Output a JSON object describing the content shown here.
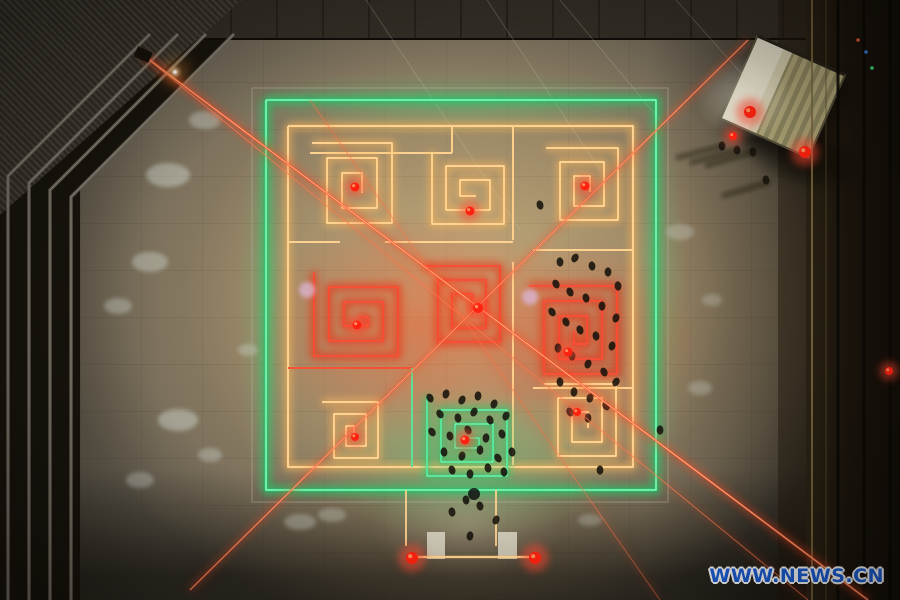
{
  "watermark": {
    "text": "WWW.NEWS.CN",
    "color": "#1a5ed8"
  },
  "palette": {
    "warm_core": "#ffeec4",
    "warm_glow": "#ffb85c",
    "green_core": "#a4ffd2",
    "green_glow": "#17cf6a",
    "red_core": "#ff7a55",
    "red_glow": "#ef2410",
    "beam": "#ff4a22",
    "beam_core": "#ffc79c",
    "metal": "#6e695e",
    "metal_hi": "#b4af9f",
    "person": "#17120b",
    "snow": "#ccd1c8",
    "shadow": "#100c06",
    "ramp": "#d8d3c2",
    "lantern": "#ff2210",
    "lantern_glow": "#ff4a30",
    "lantern_hi": "#ff8c5a"
  },
  "rails": [
    [
      [
        150,
        34
      ],
      [
        8,
        176
      ],
      [
        8,
        600
      ]
    ],
    [
      [
        178,
        34
      ],
      [
        29,
        183
      ],
      [
        29,
        600
      ]
    ],
    [
      [
        206,
        34
      ],
      [
        50,
        190
      ],
      [
        50,
        600
      ]
    ],
    [
      [
        234,
        34
      ],
      [
        71,
        197
      ],
      [
        71,
        600
      ]
    ]
  ],
  "strip_lines": [
    {
      "x": 812,
      "c": "#7a6a40",
      "w": 2,
      "o": 0.85
    },
    {
      "x": 838,
      "c": "#0b0905",
      "w": 3,
      "o": 0.9
    },
    {
      "x": 864,
      "c": "#0b0905",
      "w": 3,
      "o": 0.9
    },
    {
      "x": 890,
      "c": "#0b0905",
      "w": 3,
      "o": 0.9
    },
    {
      "x": 826,
      "c": "#5c4d2c",
      "w": 1.2,
      "o": 0.6
    }
  ],
  "snow_patches": [
    [
      168,
      175,
      22,
      12,
      0.5
    ],
    [
      150,
      262,
      18,
      10,
      0.45
    ],
    [
      118,
      306,
      14,
      8,
      0.4
    ],
    [
      178,
      420,
      20,
      11,
      0.5
    ],
    [
      210,
      455,
      12,
      7,
      0.4
    ],
    [
      300,
      522,
      16,
      8,
      0.38
    ],
    [
      680,
      232,
      14,
      8,
      0.35
    ],
    [
      700,
      388,
      12,
      7,
      0.32
    ],
    [
      248,
      350,
      10,
      6,
      0.4
    ],
    [
      332,
      515,
      14,
      7,
      0.35
    ],
    [
      590,
      520,
      12,
      6,
      0.3
    ],
    [
      712,
      300,
      10,
      6,
      0.3
    ],
    [
      205,
      120,
      16,
      9,
      0.45
    ],
    [
      140,
      480,
      14,
      8,
      0.42
    ]
  ],
  "cables": [
    [
      366,
      0,
      520,
      230
    ],
    [
      487,
      0,
      600,
      170
    ],
    [
      676,
      0,
      758,
      92
    ],
    [
      560,
      0,
      660,
      120
    ]
  ],
  "fence": [
    [
      252,
      88
    ],
    [
      668,
      88
    ],
    [
      668,
      502
    ],
    [
      252,
      502
    ],
    [
      252,
      88
    ]
  ],
  "maze": {
    "borders": [
      {
        "pts": [
          [
            266,
            100
          ],
          [
            656,
            100
          ],
          [
            656,
            490
          ],
          [
            266,
            490
          ],
          [
            266,
            100
          ]
        ],
        "type": "green",
        "w": 2.8
      },
      {
        "pts": [
          [
            288,
            126
          ],
          [
            633,
            126
          ],
          [
            633,
            467
          ],
          [
            288,
            467
          ],
          [
            288,
            126
          ]
        ],
        "type": "warm",
        "w": 2.2
      }
    ],
    "connectors": [
      {
        "pts": [
          [
            310,
            153
          ],
          [
            452,
            153
          ]
        ],
        "type": "warm"
      },
      {
        "pts": [
          [
            452,
            126
          ],
          [
            452,
            153
          ]
        ],
        "type": "warm"
      },
      {
        "pts": [
          [
            513,
            126
          ],
          [
            513,
            240
          ]
        ],
        "type": "warm"
      },
      {
        "pts": [
          [
            513,
            262
          ],
          [
            513,
            465
          ]
        ],
        "type": "warm"
      },
      {
        "pts": [
          [
            288,
            242
          ],
          [
            340,
            242
          ]
        ],
        "type": "warm"
      },
      {
        "pts": [
          [
            385,
            242
          ],
          [
            513,
            242
          ]
        ],
        "type": "warm"
      },
      {
        "pts": [
          [
            288,
            368
          ],
          [
            412,
            368
          ]
        ],
        "type": "red"
      },
      {
        "pts": [
          [
            533,
            250
          ],
          [
            633,
            250
          ]
        ],
        "type": "warm"
      },
      {
        "pts": [
          [
            533,
            388
          ],
          [
            633,
            388
          ]
        ],
        "type": "warm"
      },
      {
        "pts": [
          [
            412,
            368
          ],
          [
            412,
            467
          ]
        ],
        "type": "green"
      }
    ],
    "spirals": [
      {
        "cx": 352,
        "cy": 183,
        "r": 40,
        "gap": 15,
        "ccw": false,
        "type": "warm"
      },
      {
        "cx": 468,
        "cy": 188,
        "r": 36,
        "gap": 14,
        "ccw": true,
        "type": "warm"
      },
      {
        "cx": 582,
        "cy": 184,
        "r": 36,
        "gap": 14,
        "ccw": false,
        "type": "warm"
      },
      {
        "cx": 356,
        "cy": 314,
        "r": 42,
        "gap": 15,
        "ccw": true,
        "type": "red"
      },
      {
        "cx": 462,
        "cy": 304,
        "r": 38,
        "gap": 14,
        "ccw": false,
        "type": "red"
      },
      {
        "cx": 573,
        "cy": 330,
        "r": 44,
        "gap": 15,
        "ccw": false,
        "type": "red"
      },
      {
        "cx": 350,
        "cy": 430,
        "r": 28,
        "gap": 12,
        "ccw": false,
        "type": "warm"
      },
      {
        "cx": 467,
        "cy": 436,
        "r": 40,
        "gap": 14,
        "ccw": true,
        "type": "green"
      },
      {
        "cx": 580,
        "cy": 420,
        "r": 36,
        "gap": 14,
        "ccw": false,
        "type": "warm"
      }
    ]
  },
  "entrance": {
    "verticals": [
      [
        [
          406,
          490
        ],
        [
          406,
          546
        ]
      ],
      [
        [
          496,
          490
        ],
        [
          496,
          546
        ]
      ]
    ],
    "bar": [
      [
        410,
        557
      ],
      [
        534,
        557
      ]
    ],
    "ramps": [
      [
        427,
        532,
        18,
        27
      ],
      [
        498,
        532,
        19,
        27
      ]
    ],
    "post_blob": [
      474,
      494
    ]
  },
  "beams": [
    {
      "x1": 143,
      "y1": 55,
      "x2": 868,
      "y2": 600,
      "w": 2.2,
      "o": 0.85
    },
    {
      "x1": 143,
      "y1": 55,
      "x2": 808,
      "y2": 600,
      "w": 1.3,
      "o": 0.45
    },
    {
      "x1": 748,
      "y1": 40,
      "x2": 190,
      "y2": 590,
      "w": 1.8,
      "o": 0.7
    },
    {
      "x1": 310,
      "y1": 100,
      "x2": 660,
      "y2": 600,
      "w": 1.1,
      "o": 0.4
    }
  ],
  "flare": {
    "x": 175,
    "y": 72,
    "fixture": [
      143,
      55
    ]
  },
  "lanterns": [
    [
      355,
      187,
      4.5
    ],
    [
      470,
      211,
      4.5
    ],
    [
      585,
      186,
      4.5
    ],
    [
      357,
      325,
      4.5
    ],
    [
      478,
      308,
      5
    ],
    [
      568,
      352,
      4.5
    ],
    [
      355,
      437,
      4
    ],
    [
      465,
      440,
      4.5
    ],
    [
      577,
      412,
      4
    ],
    [
      412,
      558,
      6
    ],
    [
      535,
      558,
      6
    ],
    [
      750,
      112,
      6
    ],
    [
      805,
      152,
      6
    ],
    [
      733,
      136,
      4
    ],
    [
      889,
      371,
      4
    ]
  ],
  "tent_leds": [
    [
      866,
      52,
      "#4488ff"
    ],
    [
      872,
      68,
      "#44ff88"
    ],
    [
      858,
      40,
      "#ff6633"
    ]
  ],
  "balloons": [
    [
      530,
      297
    ],
    [
      307,
      290
    ]
  ],
  "shadows": [
    [
      722,
      146,
      676,
      158
    ],
    [
      737,
      150,
      690,
      163
    ],
    [
      753,
      152,
      705,
      166
    ],
    [
      770,
      182,
      722,
      196
    ]
  ],
  "people": [
    [
      560,
      262
    ],
    [
      575,
      258
    ],
    [
      592,
      266
    ],
    [
      608,
      272
    ],
    [
      618,
      286
    ],
    [
      556,
      284
    ],
    [
      570,
      292
    ],
    [
      586,
      298
    ],
    [
      602,
      306
    ],
    [
      616,
      318
    ],
    [
      552,
      312
    ],
    [
      566,
      322
    ],
    [
      580,
      330
    ],
    [
      596,
      336
    ],
    [
      612,
      346
    ],
    [
      558,
      348
    ],
    [
      572,
      356
    ],
    [
      588,
      364
    ],
    [
      604,
      372
    ],
    [
      616,
      382
    ],
    [
      560,
      382
    ],
    [
      574,
      392
    ],
    [
      590,
      398
    ],
    [
      606,
      406
    ],
    [
      570,
      412
    ],
    [
      588,
      418
    ],
    [
      430,
      398
    ],
    [
      446,
      394
    ],
    [
      462,
      400
    ],
    [
      478,
      396
    ],
    [
      494,
      404
    ],
    [
      440,
      414
    ],
    [
      458,
      418
    ],
    [
      474,
      412
    ],
    [
      490,
      420
    ],
    [
      506,
      416
    ],
    [
      432,
      432
    ],
    [
      450,
      436
    ],
    [
      468,
      430
    ],
    [
      486,
      438
    ],
    [
      502,
      434
    ],
    [
      444,
      452
    ],
    [
      462,
      456
    ],
    [
      480,
      450
    ],
    [
      498,
      458
    ],
    [
      512,
      452
    ],
    [
      452,
      470
    ],
    [
      470,
      474
    ],
    [
      488,
      468
    ],
    [
      504,
      472
    ],
    [
      466,
      500
    ],
    [
      480,
      506
    ],
    [
      452,
      512
    ],
    [
      496,
      520
    ],
    [
      470,
      536
    ],
    [
      722,
      146
    ],
    [
      737,
      150
    ],
    [
      753,
      152
    ],
    [
      766,
      180
    ],
    [
      540,
      205
    ],
    [
      600,
      470
    ],
    [
      660,
      430
    ]
  ]
}
